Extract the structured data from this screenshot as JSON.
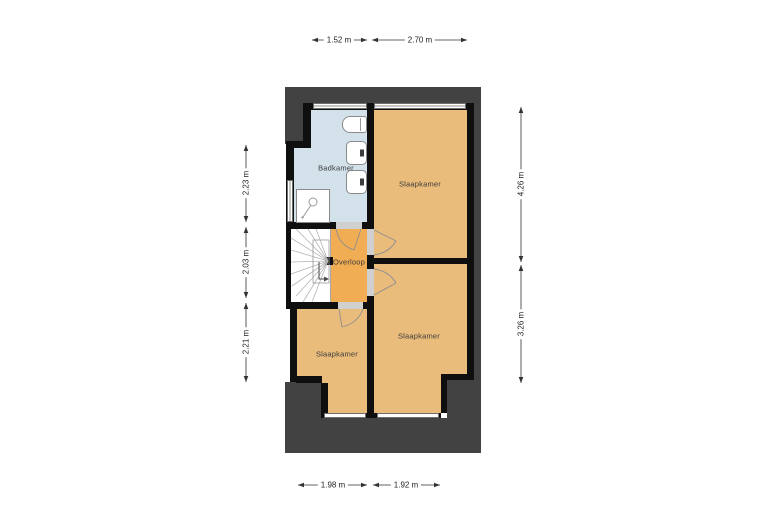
{
  "floorplan": {
    "rooms": [
      {
        "id": "badkamer",
        "name": "Badkamer"
      },
      {
        "id": "slaapkamer-top-right",
        "name": "Slaapkamer"
      },
      {
        "id": "overloop",
        "name": "Overloop"
      },
      {
        "id": "slaapkamer-mid-right",
        "name": "Slaapkamer"
      },
      {
        "id": "slaapkamer-bottom-left",
        "name": "Slaapkamer"
      }
    ],
    "dimensions": {
      "top": [
        "1.52 m",
        "2.70 m"
      ],
      "bottom": [
        "1.98 m",
        "1.92 m"
      ],
      "left": [
        "2.23 m",
        "2.03 m",
        "2.21 m"
      ],
      "right": [
        "4.26 m",
        "3.26 m"
      ]
    },
    "fixtures": [
      "toilet",
      "washbasin",
      "washbasin",
      "shower",
      "winder-stairs"
    ],
    "colors": {
      "roof_silhouette": "#424242",
      "wall": "#0f0f0f",
      "bathroom_floor": "#d3e1eb",
      "bedroom_floor": "#e9bc7b",
      "landing_floor": "#f1ad53",
      "dimension_text": "#222222"
    }
  }
}
